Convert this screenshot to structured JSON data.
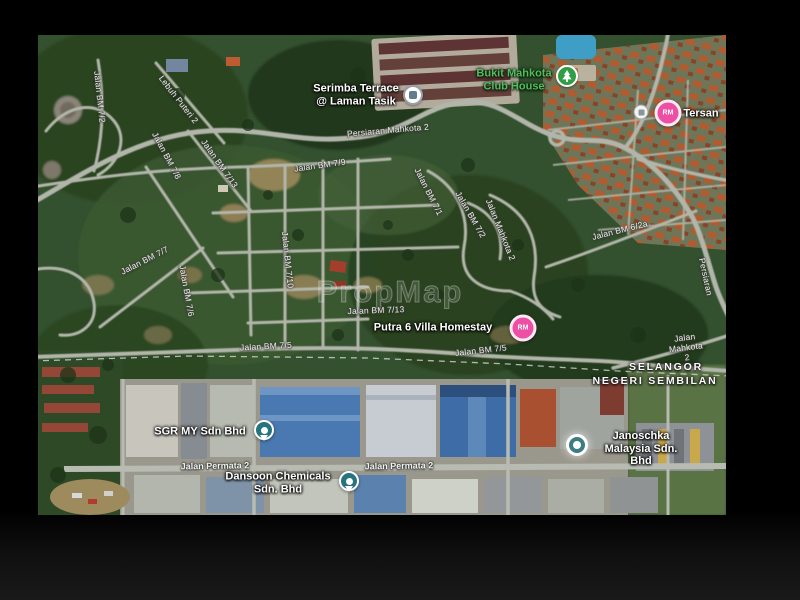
{
  "map": {
    "watermark": "PropMap",
    "colors": {
      "price_pin_pink": "#ec4fa4",
      "park_pin_green": "#2f9e44",
      "park_text_green": "#55bb5e",
      "business_pin_teal": "#26747e",
      "road_fill": "#b2b6aa",
      "letterbox": "#000000"
    },
    "labels": [
      {
        "id": "persiaran-mahkota-2",
        "text": "Persiaran Mahkota 2",
        "type": "road",
        "x": 350,
        "y": 96,
        "rot": -5
      },
      {
        "id": "jalan-bm-7-9",
        "text": "Jalan BM 7/9",
        "type": "road",
        "x": 282,
        "y": 131,
        "rot": -8
      },
      {
        "id": "jalan-bm-7-13-diagonal",
        "text": "Jalan BM 7/13",
        "type": "road",
        "x": 181,
        "y": 129,
        "rot": 55
      },
      {
        "id": "jalan-bm-7-8",
        "text": "Jalan BM 7/8",
        "type": "road",
        "x": 128,
        "y": 121,
        "rot": 62
      },
      {
        "id": "jalan-bm-7-2-left",
        "text": "Jalan BM 7/2",
        "type": "road",
        "x": 61,
        "y": 62,
        "rot": 84
      },
      {
        "id": "lebuh-puteri-2",
        "text": "Lebuh Puteri 2",
        "type": "road",
        "x": 140,
        "y": 65,
        "rot": 52
      },
      {
        "id": "jalan-bm-7-7",
        "text": "Jalan BM 7/7",
        "type": "road",
        "x": 107,
        "y": 226,
        "rot": -27
      },
      {
        "id": "jalan-bm-7-6",
        "text": "Jalan BM 7/6",
        "type": "road",
        "x": 148,
        "y": 256,
        "rot": 80
      },
      {
        "id": "jalan-bm-7-10",
        "text": "Jalan BM 7/10",
        "type": "road",
        "x": 249,
        "y": 225,
        "rot": 84
      },
      {
        "id": "jalan-bm-7-1",
        "text": "Jalan BM 7/1",
        "type": "road",
        "x": 390,
        "y": 157,
        "rot": 63
      },
      {
        "id": "jalan-bm-7-2-right",
        "text": "Jalan BM 7/2",
        "type": "road",
        "x": 432,
        "y": 180,
        "rot": 60
      },
      {
        "id": "jalan-mahkota-2-mid",
        "text": "Jalan Mahkota 2",
        "type": "road",
        "x": 462,
        "y": 195,
        "rot": 68
      },
      {
        "id": "jalan-bm-6-2a",
        "text": "Jalan BM 6/2a",
        "type": "road",
        "x": 582,
        "y": 196,
        "rot": -14
      },
      {
        "id": "persiaran-right-edge",
        "text": "Persiaran",
        "type": "road",
        "x": 667,
        "y": 242,
        "rot": 78
      },
      {
        "id": "jalan-bm-7-13-horizontal",
        "text": "Jalan BM 7/13",
        "type": "road",
        "x": 338,
        "y": 276,
        "rot": -2
      },
      {
        "id": "jalan-bm-7-5-left",
        "text": "Jalan BM 7/5",
        "type": "road",
        "x": 228,
        "y": 312,
        "rot": -3
      },
      {
        "id": "jalan-bm-7-5-right",
        "text": "Jalan BM 7/5",
        "type": "road",
        "x": 443,
        "y": 316,
        "rot": -6
      },
      {
        "id": "jalan-mahkota-2-bottom",
        "text": "Jalan Mahkota 2",
        "type": "road",
        "x": 648,
        "y": 313,
        "rot": -7
      },
      {
        "id": "jalan-permata-2-left",
        "text": "Jalan Permata 2",
        "type": "road-bold",
        "x": 177,
        "y": 431,
        "rot": -1
      },
      {
        "id": "jalan-permata-2-right",
        "text": "Jalan Permata 2",
        "type": "road-bold",
        "x": 361,
        "y": 431,
        "rot": -1
      },
      {
        "id": "serimba-terrace",
        "text": "Serimba Terrace\n@ Laman Tasik",
        "type": "place",
        "x": 318,
        "y": 60
      },
      {
        "id": "bukit-mahkota-club-house",
        "text": "Bukit Mahkota\nClub House",
        "type": "park",
        "x": 476,
        "y": 45
      },
      {
        "id": "tersan-truncated",
        "text": "Tersan",
        "type": "place",
        "x": 663,
        "y": 79
      },
      {
        "id": "putra-6-villa-homestay",
        "text": "Putra 6 Villa Homestay",
        "type": "place",
        "x": 395,
        "y": 293
      },
      {
        "id": "sgr-my-sdn-bhd",
        "text": "SGR MY Sdn Bhd",
        "type": "place",
        "x": 162,
        "y": 397
      },
      {
        "id": "dansoon-chemicals",
        "text": "Dansoon Chemicals\nSdn. Bhd",
        "type": "place",
        "x": 240,
        "y": 448
      },
      {
        "id": "janoschka-malaysia",
        "text": "Janoschka\nMalaysia Sdn. Bhd",
        "type": "place",
        "x": 603,
        "y": 414
      },
      {
        "id": "selangor",
        "text": "SELANGOR",
        "type": "boundary",
        "x": 628,
        "y": 332
      },
      {
        "id": "negeri-sembilan",
        "text": "NEGERI SEMBILAN",
        "type": "boundary",
        "x": 617,
        "y": 346
      }
    ],
    "markers": [
      {
        "id": "serimba-terrace-marker",
        "kind": "poi-white",
        "x": 375,
        "y": 60
      },
      {
        "id": "club-house-marker",
        "kind": "park",
        "x": 529,
        "y": 41
      },
      {
        "id": "price-marker-top-right",
        "kind": "price",
        "label": "RM",
        "x": 630,
        "y": 78
      },
      {
        "id": "info-marker-top-right",
        "kind": "poi-small",
        "x": 603,
        "y": 77
      },
      {
        "id": "price-marker-putra",
        "kind": "price",
        "label": "RM",
        "x": 485,
        "y": 293
      },
      {
        "id": "sgr-my-marker",
        "kind": "business",
        "x": 226,
        "y": 395
      },
      {
        "id": "dansoon-marker",
        "kind": "business",
        "x": 311,
        "y": 446
      },
      {
        "id": "janoschka-marker",
        "kind": "business-light",
        "x": 539,
        "y": 410
      }
    ]
  }
}
